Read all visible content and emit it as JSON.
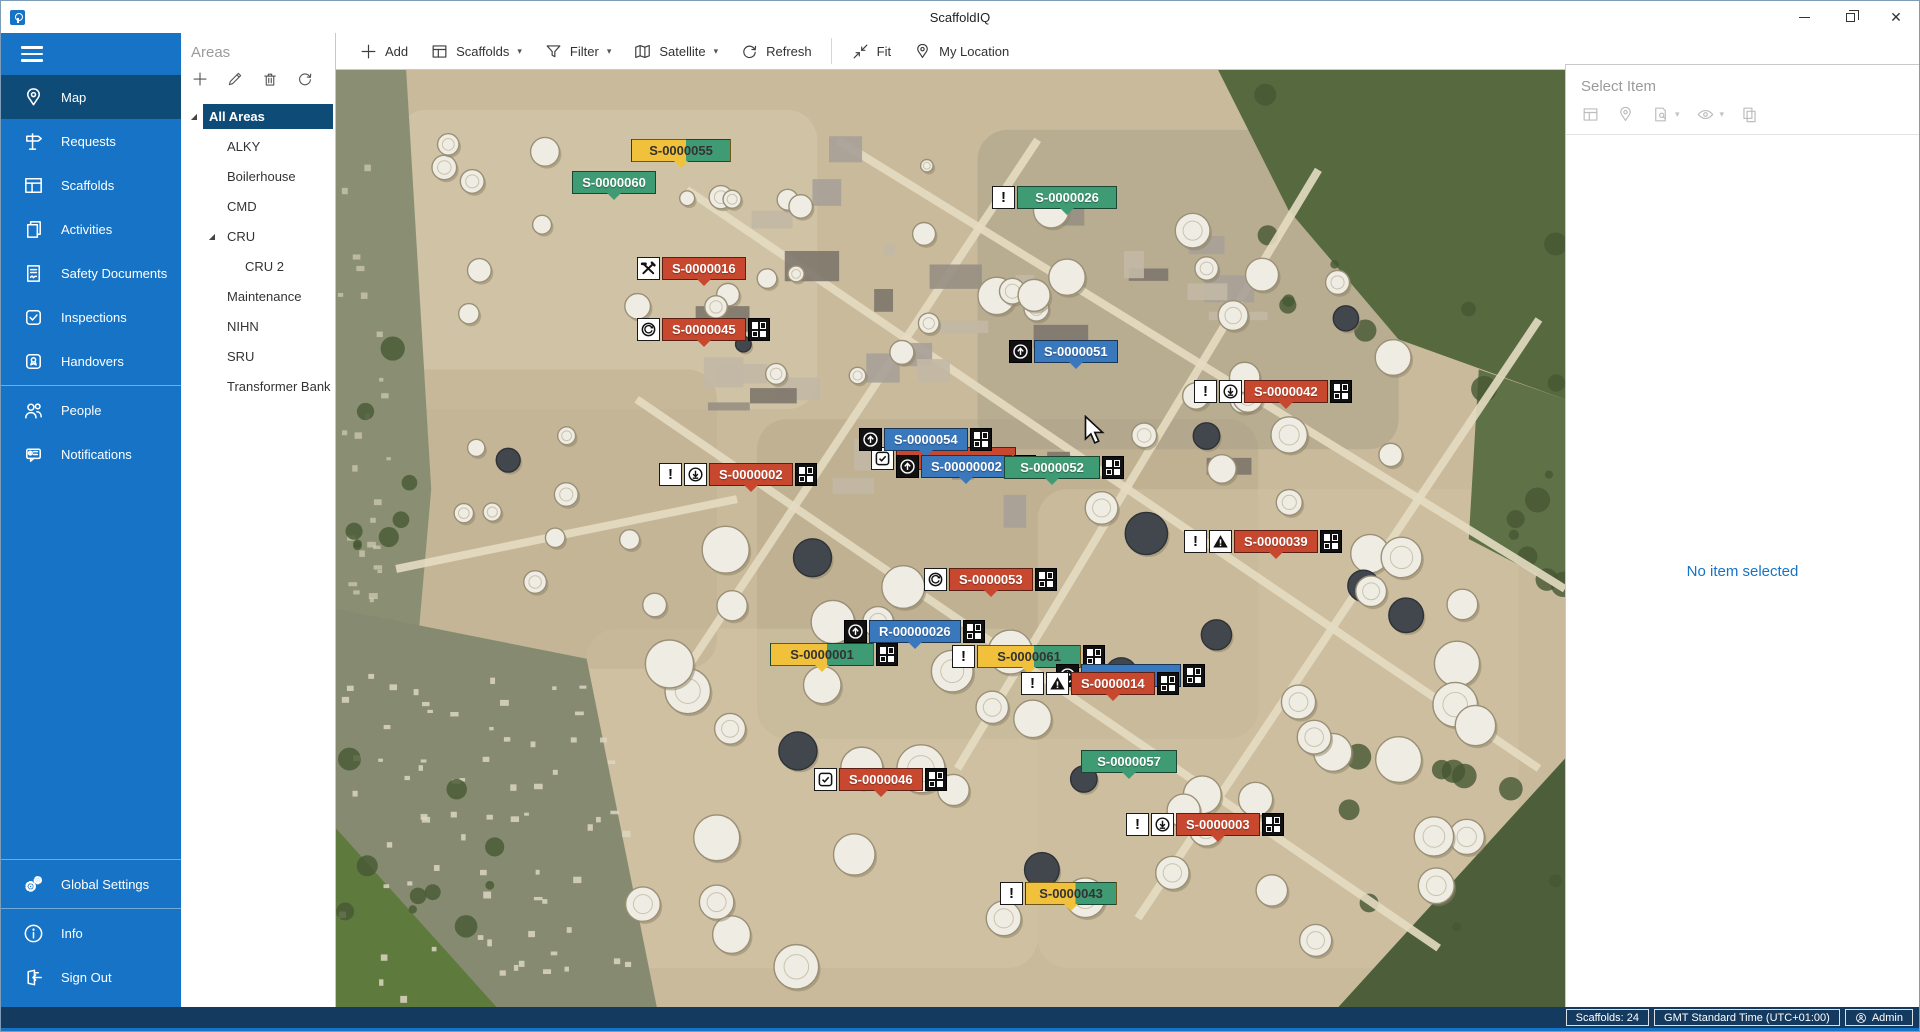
{
  "window": {
    "title": "ScaffoldIQ",
    "controls": [
      "minimize",
      "restore",
      "close"
    ]
  },
  "colors": {
    "sidebar_blue": "#1673c5",
    "selected_navy": "#0f4b77",
    "statusbar_navy": "#143a60",
    "marker_red": "#c7482f",
    "marker_green": "#3f9b74",
    "marker_blue": "#3a78bd",
    "marker_yellow": "#f2c13c"
  },
  "sidebar": {
    "items": [
      {
        "label": "Map",
        "icon": "map-pin",
        "selected": true
      },
      {
        "label": "Requests",
        "icon": "signpost"
      },
      {
        "label": "Scaffolds",
        "icon": "table"
      },
      {
        "label": "Activities",
        "icon": "copies"
      },
      {
        "label": "Safety Documents",
        "icon": "document"
      },
      {
        "label": "Inspections",
        "icon": "checkbox"
      },
      {
        "label": "Handovers",
        "icon": "badge"
      },
      {
        "divider": true
      },
      {
        "label": "People",
        "icon": "people"
      },
      {
        "label": "Notifications",
        "icon": "bubble"
      }
    ],
    "footer_items": [
      {
        "divider": true
      },
      {
        "label": "Global Settings",
        "icon": "gears"
      },
      {
        "divider": true
      },
      {
        "label": "Info",
        "icon": "info"
      },
      {
        "label": "Sign Out",
        "icon": "signout"
      }
    ]
  },
  "areas": {
    "title": "Areas",
    "tools": [
      "add",
      "edit",
      "delete",
      "refresh"
    ],
    "tree": [
      {
        "label": "All Areas",
        "level": 0,
        "expanded": true,
        "selected": true
      },
      {
        "label": "ALKY",
        "level": 1
      },
      {
        "label": "Boilerhouse",
        "level": 1
      },
      {
        "label": "CMD",
        "level": 1
      },
      {
        "label": "CRU",
        "level": 1,
        "expanded": true
      },
      {
        "label": "CRU 2",
        "level": 2
      },
      {
        "label": "Maintenance",
        "level": 1
      },
      {
        "label": "NIHN",
        "level": 1
      },
      {
        "label": "SRU",
        "level": 1
      },
      {
        "label": "Transformer Bank",
        "level": 1
      }
    ]
  },
  "toolbar": {
    "buttons": [
      {
        "label": "Add",
        "icon": "plus"
      },
      {
        "label": "Scaffolds",
        "icon": "table",
        "caret": true
      },
      {
        "label": "Filter",
        "icon": "funnel",
        "caret": true
      },
      {
        "label": "Satellite",
        "icon": "foldmap",
        "caret": true
      },
      {
        "label": "Refresh",
        "icon": "refresh"
      },
      {
        "label": "Fit",
        "icon": "fit",
        "sep_before": true
      },
      {
        "label": "My Location",
        "icon": "map-pin"
      }
    ]
  },
  "right_panel": {
    "header": "Select Item",
    "tools": [
      {
        "icon": "table"
      },
      {
        "icon": "map-pin"
      },
      {
        "icon": "docsearch",
        "caret": true
      },
      {
        "icon": "eye",
        "caret": true
      },
      {
        "icon": "copy"
      }
    ],
    "empty_text": "No item selected"
  },
  "status_bar": {
    "items": [
      {
        "text": "Scaffolds: 24"
      },
      {
        "text": "GMT Standard Time (UTC+01:00)"
      },
      {
        "text": "Admin",
        "icon": "person"
      }
    ]
  },
  "map": {
    "markers": [
      {
        "label": "S-0000055",
        "color": "split",
        "icons": [],
        "grid": false,
        "x": 295,
        "y": 69,
        "mw": 100
      },
      {
        "label": "S-0000060",
        "color": "green",
        "icons": [],
        "grid": false,
        "x": 236,
        "y": 101,
        "mw": 84
      },
      {
        "label": "S-0000026",
        "color": "green",
        "icons": [
          "alert"
        ],
        "grid": false,
        "x": 656,
        "y": 116,
        "mw": 100
      },
      {
        "label": "S-0000016",
        "color": "red",
        "icons": [
          "tools"
        ],
        "grid": false,
        "x": 301,
        "y": 187,
        "mw": 80
      },
      {
        "label": "S-0000045",
        "color": "red",
        "icons": [
          "refresh"
        ],
        "grid": true,
        "x": 301,
        "y": 248,
        "mw": 80
      },
      {
        "label": "S-0000051",
        "color": "blue",
        "icons": [
          "uparrow"
        ],
        "grid": false,
        "x": 673,
        "y": 270,
        "mw": 80
      },
      {
        "label": "S-0000042",
        "color": "red",
        "icons": [
          "alert",
          "download"
        ],
        "grid": true,
        "x": 858,
        "y": 310,
        "mw": 80
      },
      {
        "label": "",
        "color": "red",
        "icons": [
          "check"
        ],
        "grid": false,
        "x": 535,
        "y": 377,
        "mw": 120,
        "occluded": true
      },
      {
        "label": "S-0000054",
        "color": "blue",
        "icons": [
          "uparrow"
        ],
        "grid": true,
        "x": 523,
        "y": 358,
        "mw": 80
      },
      {
        "label": "S-00000002",
        "color": "blue",
        "icons": [
          "uparrow"
        ],
        "grid": true,
        "x": 560,
        "y": 385,
        "mw": 88
      },
      {
        "label": "S-0000052",
        "color": "green",
        "icons": [],
        "grid": true,
        "x": 668,
        "y": 386,
        "mw": 96
      },
      {
        "label": "S-0000002",
        "color": "red",
        "icons": [
          "alert",
          "download"
        ],
        "grid": true,
        "x": 323,
        "y": 393,
        "mw": 80
      },
      {
        "label": "S-0000039",
        "color": "red",
        "icons": [
          "alert",
          "warning"
        ],
        "grid": true,
        "x": 848,
        "y": 460,
        "mw": 80
      },
      {
        "label": "S-0000053",
        "color": "red",
        "icons": [
          "refresh"
        ],
        "grid": true,
        "x": 588,
        "y": 498,
        "mw": 80
      },
      {
        "label": "R-00000026",
        "color": "blue",
        "icons": [
          "uparrow"
        ],
        "grid": true,
        "x": 508,
        "y": 550,
        "mw": 88
      },
      {
        "label": "S-0000001",
        "color": "split",
        "icons": [],
        "grid": true,
        "x": 434,
        "y": 573,
        "mw": 104
      },
      {
        "label": "S-0000061",
        "color": "split",
        "icons": [
          "alert"
        ],
        "grid": true,
        "x": 616,
        "y": 575,
        "mw": 104
      },
      {
        "label": "",
        "color": "blue",
        "icons": [
          "uparrow"
        ],
        "grid": true,
        "x": 720,
        "y": 594,
        "mw": 100,
        "occluded": true
      },
      {
        "label": "S-0000014",
        "color": "red",
        "icons": [
          "alert",
          "warning"
        ],
        "grid": true,
        "x": 685,
        "y": 602,
        "mw": 72
      },
      {
        "label": "S-0000057",
        "color": "green",
        "icons": [],
        "grid": false,
        "x": 745,
        "y": 680,
        "mw": 96
      },
      {
        "label": "S-0000046",
        "color": "red",
        "icons": [
          "check"
        ],
        "grid": true,
        "x": 478,
        "y": 698,
        "mw": 82
      },
      {
        "label": "S-0000003",
        "color": "red",
        "icons": [
          "alert",
          "download"
        ],
        "grid": true,
        "x": 790,
        "y": 743,
        "mw": 80
      },
      {
        "label": "S-0000043",
        "color": "split",
        "icons": [
          "alert"
        ],
        "grid": false,
        "x": 664,
        "y": 812,
        "mw": 92
      }
    ]
  }
}
